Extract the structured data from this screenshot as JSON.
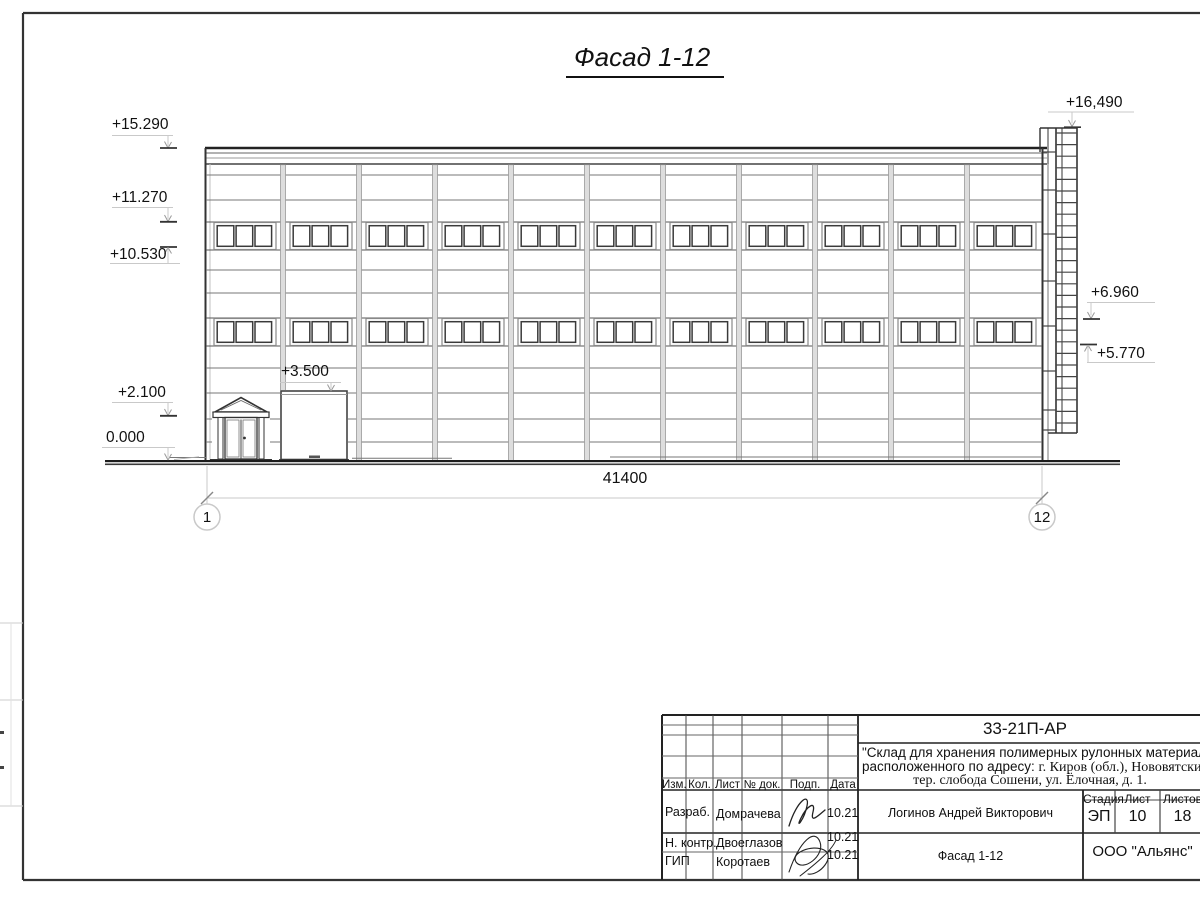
{
  "drawing": {
    "title": "Фасад 1-12",
    "dimension_total": "41400",
    "axis_start": "1",
    "axis_end": "12",
    "marks": {
      "m15290": "+15.290",
      "m11270": "+11.270",
      "m10530": "+10.530",
      "m2100": "+2.100",
      "m0000": "0.000",
      "m16490": "+16,490",
      "m6960": "+6.960",
      "m5770": "+5.770",
      "m3500": "+3.500"
    }
  },
  "title_block": {
    "doc_code": "33-21П-АР",
    "project_line1": "\"Склад для хранения полимерных рулонных материалов",
    "project_line2a": "расположенного по адресу: ",
    "project_line2b": "г. Киров (обл.), Нововятский р-",
    "project_line3": "тер. слобода Сошени, ул. Ёлочная, д. 1.",
    "rev_headers": {
      "izm": "Изм.",
      "kol": "Кол.",
      "list": "Лист",
      "doc": "№ док.",
      "podp": "Подп.",
      "data": "Дата"
    },
    "staff": [
      {
        "role": "Разраб.",
        "name": "Домрачева",
        "date": "10.21"
      },
      {
        "role": "Н. контр.",
        "name": "Двоеглазов",
        "date": "10.21"
      },
      {
        "role": "ГИП",
        "name": "Коротаев",
        "date": "10.21"
      }
    ],
    "approver": "Логинов Андрей Викторович",
    "stage_header": "Стадия",
    "sheet_header": "Лист",
    "sheets_header": "Листов",
    "stage": "ЭП",
    "sheet": "10",
    "sheets": "18",
    "drawing_name": "Фасад 1-12",
    "company": "ООО \"Альянс\""
  }
}
